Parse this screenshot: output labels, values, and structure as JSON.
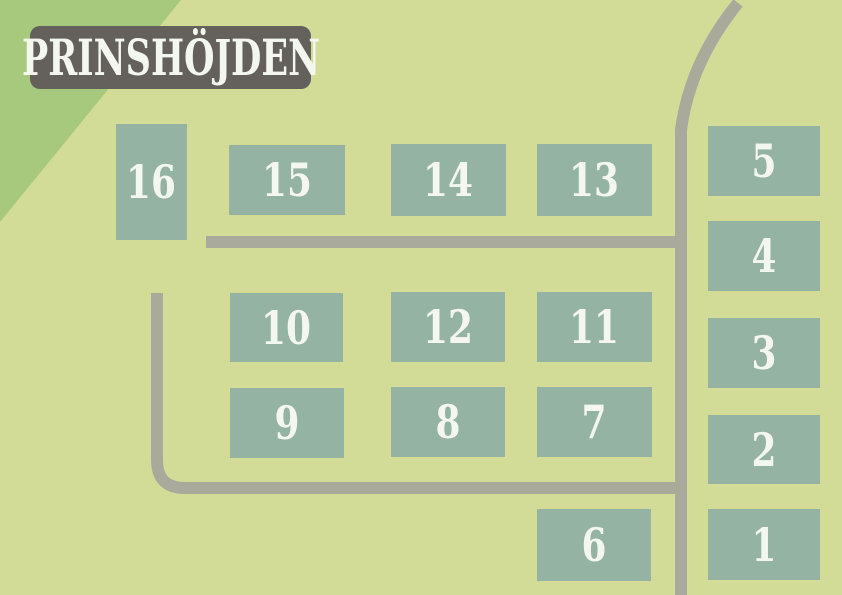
{
  "title": "PRINSHÖJDEN",
  "map": {
    "lots": [
      {
        "id": 1,
        "label": "1"
      },
      {
        "id": 2,
        "label": "2"
      },
      {
        "id": 3,
        "label": "3"
      },
      {
        "id": 4,
        "label": "4"
      },
      {
        "id": 5,
        "label": "5"
      },
      {
        "id": 6,
        "label": "6"
      },
      {
        "id": 7,
        "label": "7"
      },
      {
        "id": 8,
        "label": "8"
      },
      {
        "id": 9,
        "label": "9"
      },
      {
        "id": 10,
        "label": "10"
      },
      {
        "id": 11,
        "label": "11"
      },
      {
        "id": 12,
        "label": "12"
      },
      {
        "id": 13,
        "label": "13"
      },
      {
        "id": 14,
        "label": "14"
      },
      {
        "id": 15,
        "label": "15"
      },
      {
        "id": 16,
        "label": "16"
      }
    ]
  },
  "colors": {
    "background": "#d2dc97",
    "forest": "#a6c97d",
    "lot": "#95b3a3",
    "road": "#a9aa9b",
    "title_bg": "#64615c",
    "text": "#f4f6f0"
  }
}
